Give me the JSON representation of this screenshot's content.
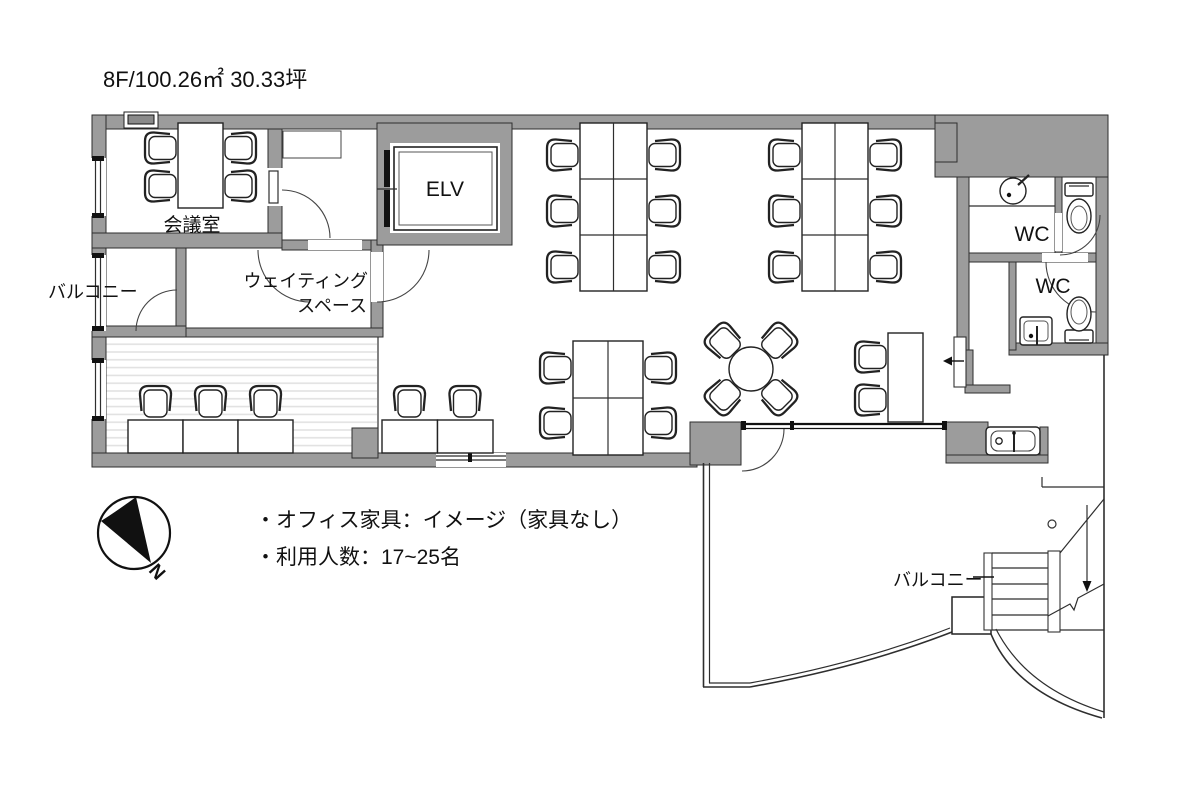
{
  "title": "8F/100.26㎡ 30.33坪",
  "labels": {
    "meeting_room": "会議室",
    "balcony_upper_left": "バルコニー",
    "waiting_space_line1": "ウェイティング",
    "waiting_space_line2": "スペース",
    "elevator": "ELV",
    "wc_upper": "WC",
    "wc_lower": "WC",
    "balcony_lower_right": "バルコニー"
  },
  "notes": {
    "furniture": "・オフィス家具：イメージ（家具なし）",
    "capacity": "・利用人数：17~25名"
  },
  "compass": {
    "north_label": "N"
  },
  "colors": {
    "wall": "#9c9c9c",
    "line": "#222222",
    "stripe": "#e0e0e0",
    "background": "#ffffff"
  }
}
